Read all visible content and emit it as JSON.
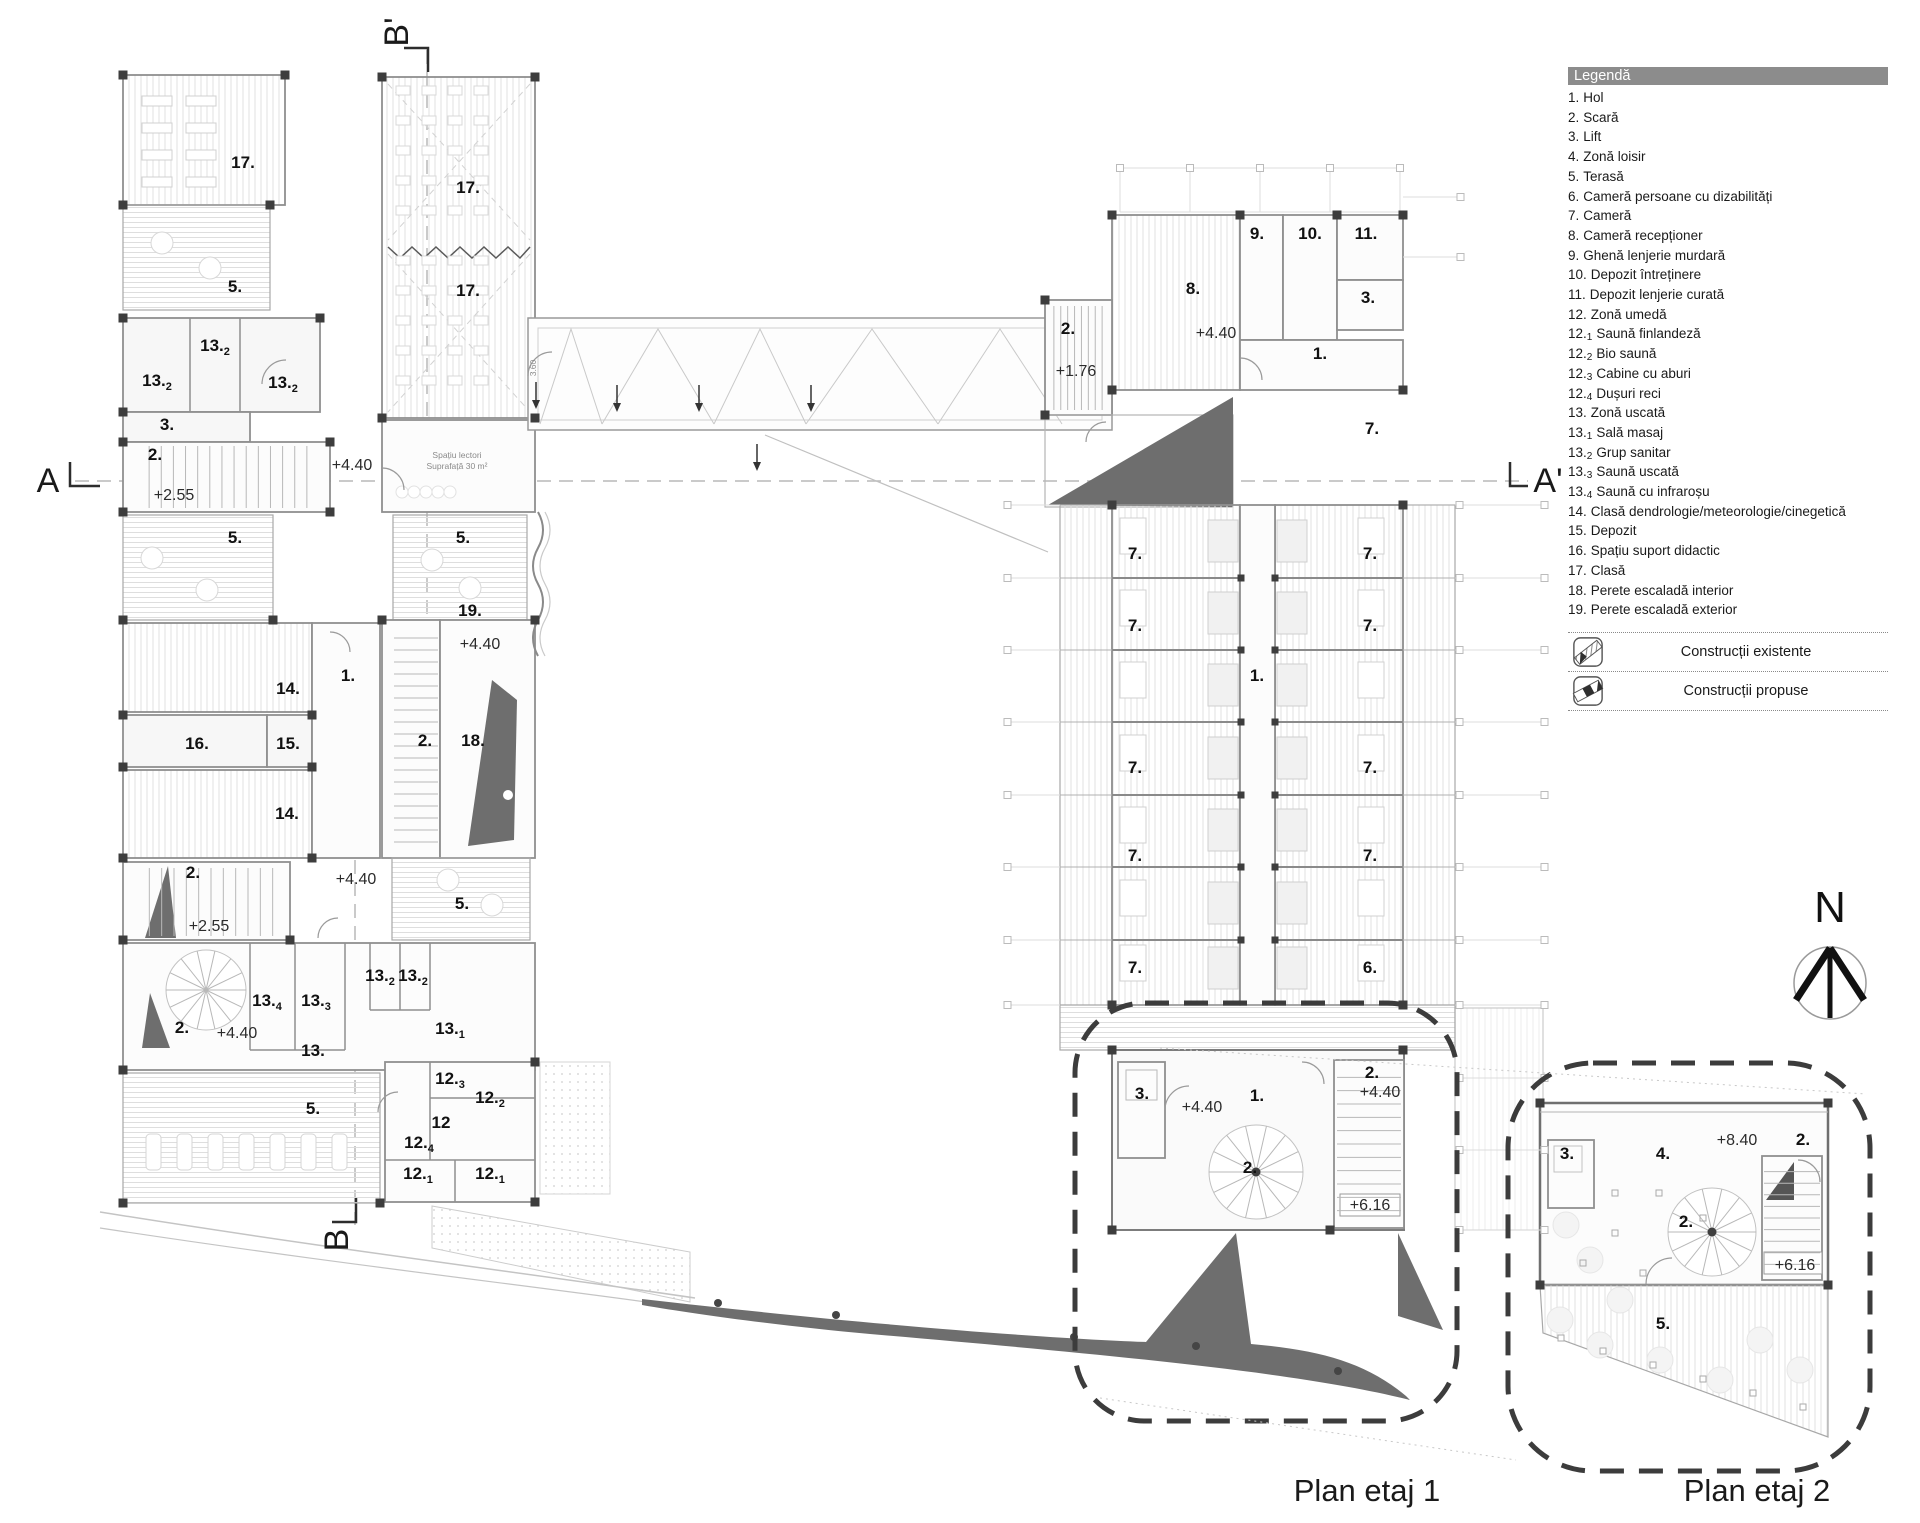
{
  "colors": {
    "wall": "#8f8f8f",
    "dark_fill": "#6e6e6e",
    "bubble_stroke": "#3c3c3c",
    "legend_header_bg": "#8c8c8c"
  },
  "compass": {
    "label": "N"
  },
  "titles": {
    "plan1": "Plan etaj 1",
    "plan2": "Plan etaj 2"
  },
  "legend": {
    "header": "Legendă",
    "items": [
      {
        "n": "1.",
        "s": "",
        "t": "Hol"
      },
      {
        "n": "2.",
        "s": "",
        "t": "Scară"
      },
      {
        "n": "3.",
        "s": "",
        "t": "Lift"
      },
      {
        "n": "4.",
        "s": "",
        "t": "Zonă loisir"
      },
      {
        "n": "5.",
        "s": "",
        "t": "Terasă"
      },
      {
        "n": "6.",
        "s": "",
        "t": "Cameră persoane cu dizabilități"
      },
      {
        "n": "7.",
        "s": "",
        "t": "Cameră"
      },
      {
        "n": "8.",
        "s": "",
        "t": "Cameră recepționer"
      },
      {
        "n": "9.",
        "s": "",
        "t": "Ghenă lenjerie murdară"
      },
      {
        "n": "10.",
        "s": "",
        "t": "Depozit întreținere"
      },
      {
        "n": "11.",
        "s": "",
        "t": "Depozit lenjerie curată"
      },
      {
        "n": "12.",
        "s": "",
        "t": "Zonă umedă"
      },
      {
        "n": "12.",
        "s": "1",
        "t": "Saună finlandeză"
      },
      {
        "n": "12.",
        "s": "2",
        "t": "Bio saună"
      },
      {
        "n": "12.",
        "s": "3",
        "t": "Cabine cu aburi"
      },
      {
        "n": "12.",
        "s": "4",
        "t": "Dușuri reci"
      },
      {
        "n": "13.",
        "s": "",
        "t": "Zonă uscată"
      },
      {
        "n": "13.",
        "s": "1",
        "t": "Sală masaj"
      },
      {
        "n": "13.",
        "s": "2",
        "t": "Grup sanitar"
      },
      {
        "n": "13.",
        "s": "3",
        "t": "Saună uscată"
      },
      {
        "n": "13.",
        "s": "4",
        "t": "Saună cu infraroșu"
      },
      {
        "n": "14.",
        "s": "",
        "t": "Clasă dendrologie/meteorologie/cinegetică"
      },
      {
        "n": "15.",
        "s": "",
        "t": "Depozit"
      },
      {
        "n": "16.",
        "s": "",
        "t": "Spațiu suport didactic"
      },
      {
        "n": "17.",
        "s": "",
        "t": "Clasă"
      },
      {
        "n": "18.",
        "s": "",
        "t": "Perete escaladă interior"
      },
      {
        "n": "19.",
        "s": "",
        "t": "Perete escaladă exterior"
      }
    ],
    "construct": [
      {
        "label": "Construcții existente",
        "icon": "existing-construction-icon"
      },
      {
        "label": "Construcții propuse",
        "icon": "proposed-construction-icon"
      }
    ]
  },
  "plan_labels": [
    {
      "t": "17.",
      "x": 243,
      "y": 168,
      "k": "rm"
    },
    {
      "t": "5.",
      "x": 235,
      "y": 292,
      "k": "rm"
    },
    {
      "t": "13.",
      "s": "2",
      "x": 215,
      "y": 351,
      "k": "rm"
    },
    {
      "t": "13.",
      "s": "2",
      "x": 157,
      "y": 386,
      "k": "rm"
    },
    {
      "t": "13.",
      "s": "2",
      "x": 283,
      "y": 388,
      "k": "rm"
    },
    {
      "t": "3.",
      "x": 167,
      "y": 430,
      "k": "rm"
    },
    {
      "t": "2.",
      "x": 155,
      "y": 460,
      "k": "rm"
    },
    {
      "t": "+2.55",
      "x": 174,
      "y": 500,
      "k": "lvl"
    },
    {
      "t": "+4.40",
      "x": 352,
      "y": 470,
      "k": "lvl"
    },
    {
      "t": "17.",
      "x": 468,
      "y": 193,
      "k": "rm"
    },
    {
      "t": "17.",
      "x": 468,
      "y": 296,
      "k": "rm"
    },
    {
      "t": "5.",
      "x": 235,
      "y": 543,
      "k": "rm"
    },
    {
      "t": "5.",
      "x": 463,
      "y": 543,
      "k": "rm"
    },
    {
      "t": "Spațiu lectori",
      "x": 457,
      "y": 458,
      "k": "sm"
    },
    {
      "t": "Suprafață 30 m²",
      "x": 457,
      "y": 469,
      "k": "sm"
    },
    {
      "t": "+4.40",
      "x": 480,
      "y": 649,
      "k": "lvl"
    },
    {
      "t": "14.",
      "x": 288,
      "y": 694,
      "k": "rm"
    },
    {
      "t": "1.",
      "x": 348,
      "y": 681,
      "k": "rm"
    },
    {
      "t": "16.",
      "x": 197,
      "y": 749,
      "k": "rm"
    },
    {
      "t": "15.",
      "x": 288,
      "y": 749,
      "k": "rm"
    },
    {
      "t": "14.",
      "x": 287,
      "y": 819,
      "k": "rm"
    },
    {
      "t": "2.",
      "x": 425,
      "y": 746,
      "k": "rm"
    },
    {
      "t": "18.",
      "x": 473,
      "y": 746,
      "k": "rm"
    },
    {
      "t": "19.",
      "x": 470,
      "y": 616,
      "k": "rm"
    },
    {
      "t": "2.",
      "x": 193,
      "y": 878,
      "k": "rm"
    },
    {
      "t": "+2.55",
      "x": 209,
      "y": 931,
      "k": "lvl"
    },
    {
      "t": "+4.40",
      "x": 356,
      "y": 884,
      "k": "lvl"
    },
    {
      "t": "5.",
      "x": 462,
      "y": 909,
      "k": "rm"
    },
    {
      "t": "2.",
      "x": 182,
      "y": 1033,
      "k": "rm"
    },
    {
      "t": "+4.40",
      "x": 237,
      "y": 1038,
      "k": "lvl"
    },
    {
      "t": "13.",
      "s": "4",
      "x": 267,
      "y": 1006,
      "k": "rm"
    },
    {
      "t": "13.",
      "s": "3",
      "x": 316,
      "y": 1006,
      "k": "rm"
    },
    {
      "t": "13.",
      "s": "2",
      "x": 380,
      "y": 981,
      "k": "rm"
    },
    {
      "t": "13.",
      "s": "2",
      "x": 413,
      "y": 981,
      "k": "rm"
    },
    {
      "t": "13.",
      "s": "1",
      "x": 450,
      "y": 1034,
      "k": "rm"
    },
    {
      "t": "13.",
      "x": 313,
      "y": 1056,
      "k": "rm"
    },
    {
      "t": "12.",
      "s": "3",
      "x": 450,
      "y": 1084,
      "k": "rm"
    },
    {
      "t": "12.",
      "s": "2",
      "x": 490,
      "y": 1103,
      "k": "rm"
    },
    {
      "t": "12",
      "x": 441,
      "y": 1128,
      "k": "rm"
    },
    {
      "t": "12.",
      "s": "4",
      "x": 419,
      "y": 1148,
      "k": "rm"
    },
    {
      "t": "12.",
      "s": "1",
      "x": 418,
      "y": 1179,
      "k": "rm"
    },
    {
      "t": "12.",
      "s": "1",
      "x": 490,
      "y": 1179,
      "k": "rm"
    },
    {
      "t": "5.",
      "x": 313,
      "y": 1114,
      "k": "rm"
    },
    {
      "t": "3.60",
      "x": 536,
      "y": 368,
      "k": "sm",
      "tr": "rotate(-90 536 368)"
    },
    {
      "t": "9.",
      "x": 1257,
      "y": 239,
      "k": "rm"
    },
    {
      "t": "10.",
      "x": 1310,
      "y": 239,
      "k": "rm"
    },
    {
      "t": "11.",
      "x": 1366,
      "y": 239,
      "k": "rm"
    },
    {
      "t": "8.",
      "x": 1193,
      "y": 294,
      "k": "rm"
    },
    {
      "t": "3.",
      "x": 1368,
      "y": 303,
      "k": "rm"
    },
    {
      "t": "2.",
      "x": 1068,
      "y": 334,
      "k": "rm"
    },
    {
      "t": "+4.40",
      "x": 1216,
      "y": 338,
      "k": "lvl"
    },
    {
      "t": "+1.76",
      "x": 1076,
      "y": 376,
      "k": "lvl"
    },
    {
      "t": "1.",
      "x": 1320,
      "y": 359,
      "k": "rm"
    },
    {
      "t": "7.",
      "x": 1372,
      "y": 434,
      "k": "rm"
    },
    {
      "t": "7.",
      "x": 1135,
      "y": 559,
      "k": "rm"
    },
    {
      "t": "7.",
      "x": 1370,
      "y": 559,
      "k": "rm"
    },
    {
      "t": "7.",
      "x": 1135,
      "y": 631,
      "k": "rm"
    },
    {
      "t": "7.",
      "x": 1370,
      "y": 631,
      "k": "rm"
    },
    {
      "t": "1.",
      "x": 1257,
      "y": 681,
      "k": "rm"
    },
    {
      "t": "7.",
      "x": 1135,
      "y": 773,
      "k": "rm"
    },
    {
      "t": "7.",
      "x": 1370,
      "y": 773,
      "k": "rm"
    },
    {
      "t": "7.",
      "x": 1135,
      "y": 861,
      "k": "rm"
    },
    {
      "t": "7.",
      "x": 1370,
      "y": 861,
      "k": "rm"
    },
    {
      "t": "7.",
      "x": 1135,
      "y": 973,
      "k": "rm"
    },
    {
      "t": "6.",
      "x": 1370,
      "y": 973,
      "k": "rm"
    },
    {
      "t": "3.",
      "x": 1142,
      "y": 1099,
      "k": "rm"
    },
    {
      "t": "+4.40",
      "x": 1202,
      "y": 1112,
      "k": "lvl"
    },
    {
      "t": "1.",
      "x": 1257,
      "y": 1101,
      "k": "rm"
    },
    {
      "t": "2.",
      "x": 1372,
      "y": 1078,
      "k": "rm"
    },
    {
      "t": "+4.40",
      "x": 1380,
      "y": 1097,
      "k": "lvl"
    },
    {
      "t": "2.",
      "x": 1250,
      "y": 1173,
      "k": "rm"
    },
    {
      "t": "+6.16",
      "x": 1370,
      "y": 1210,
      "k": "lvl"
    },
    {
      "t": "3.",
      "x": 1567,
      "y": 1159,
      "k": "rm"
    },
    {
      "t": "4.",
      "x": 1663,
      "y": 1159,
      "k": "rm"
    },
    {
      "t": "+8.40",
      "x": 1737,
      "y": 1145,
      "k": "lvl"
    },
    {
      "t": "2.",
      "x": 1803,
      "y": 1145,
      "k": "rm"
    },
    {
      "t": "2.",
      "x": 1686,
      "y": 1227,
      "k": "rm"
    },
    {
      "t": "+6.16",
      "x": 1795,
      "y": 1270,
      "k": "lvl"
    },
    {
      "t": "5.",
      "x": 1663,
      "y": 1329,
      "k": "rm"
    },
    {
      "t": "A",
      "x": 48,
      "y": 492,
      "k": "mk"
    },
    {
      "t": "A'",
      "x": 1548,
      "y": 492,
      "k": "mk"
    },
    {
      "t": "B'",
      "x": 408,
      "y": 32,
      "k": "mk",
      "tr": "rotate(-90 408 32)"
    },
    {
      "t": "B",
      "x": 348,
      "y": 1240,
      "k": "mk",
      "tr": "rotate(-90 348 1240)"
    },
    {
      "t": "Plan etaj 1",
      "x": 1367,
      "y": 1501,
      "k": "ti"
    },
    {
      "t": "Plan etaj 2",
      "x": 1757,
      "y": 1501,
      "k": "ti"
    }
  ]
}
